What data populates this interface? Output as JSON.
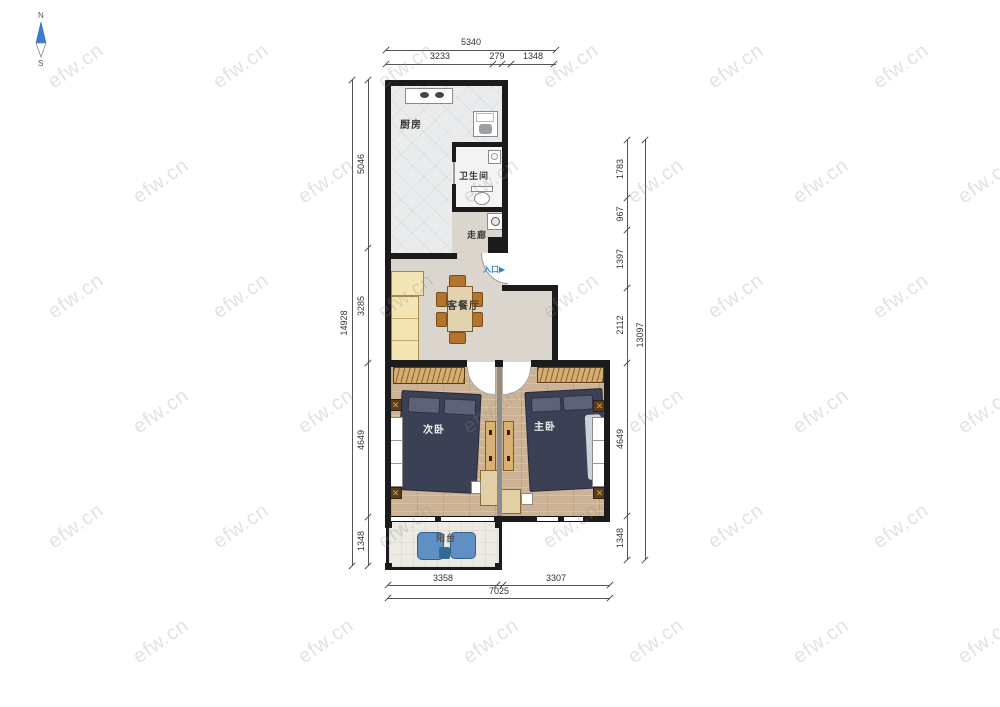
{
  "compass": {
    "north": "N",
    "south": "S"
  },
  "watermark": {
    "text": "efw.cn"
  },
  "rooms": {
    "kitchen": "厨房",
    "bathroom": "卫生间",
    "corridor": "走廊",
    "living_dining": "客餐厅",
    "second_bedroom": "次卧",
    "master_bedroom": "主卧",
    "balcony": "阳台",
    "entrance": "入口",
    "entrance_arrow": "▶"
  },
  "dimensions": {
    "top": {
      "total": "5340",
      "segments": [
        "3233",
        "279",
        "1348"
      ]
    },
    "bottom": {
      "total": "7025",
      "segments": [
        "3358",
        "3307"
      ]
    },
    "left": {
      "total": "14928",
      "segments": [
        "5046",
        "3285",
        "4649",
        "1348"
      ]
    },
    "right": {
      "total": "13097",
      "segments": [
        "1783",
        "967",
        "1397",
        "2112",
        "4649",
        "1348"
      ]
    }
  },
  "colors": {
    "wall": "#1b1b1b",
    "entry_blue": "#2e7fd0",
    "bed": "#3c4055",
    "wood_floor": "#ccb395",
    "wardrobe": "#d7ad6f",
    "sofa": "#f4e6b4",
    "dining_chair": "#b5742e",
    "balcony_chair": "#5f90c3",
    "dimension_text": "#333333",
    "watermark": "#8c8c8c"
  }
}
